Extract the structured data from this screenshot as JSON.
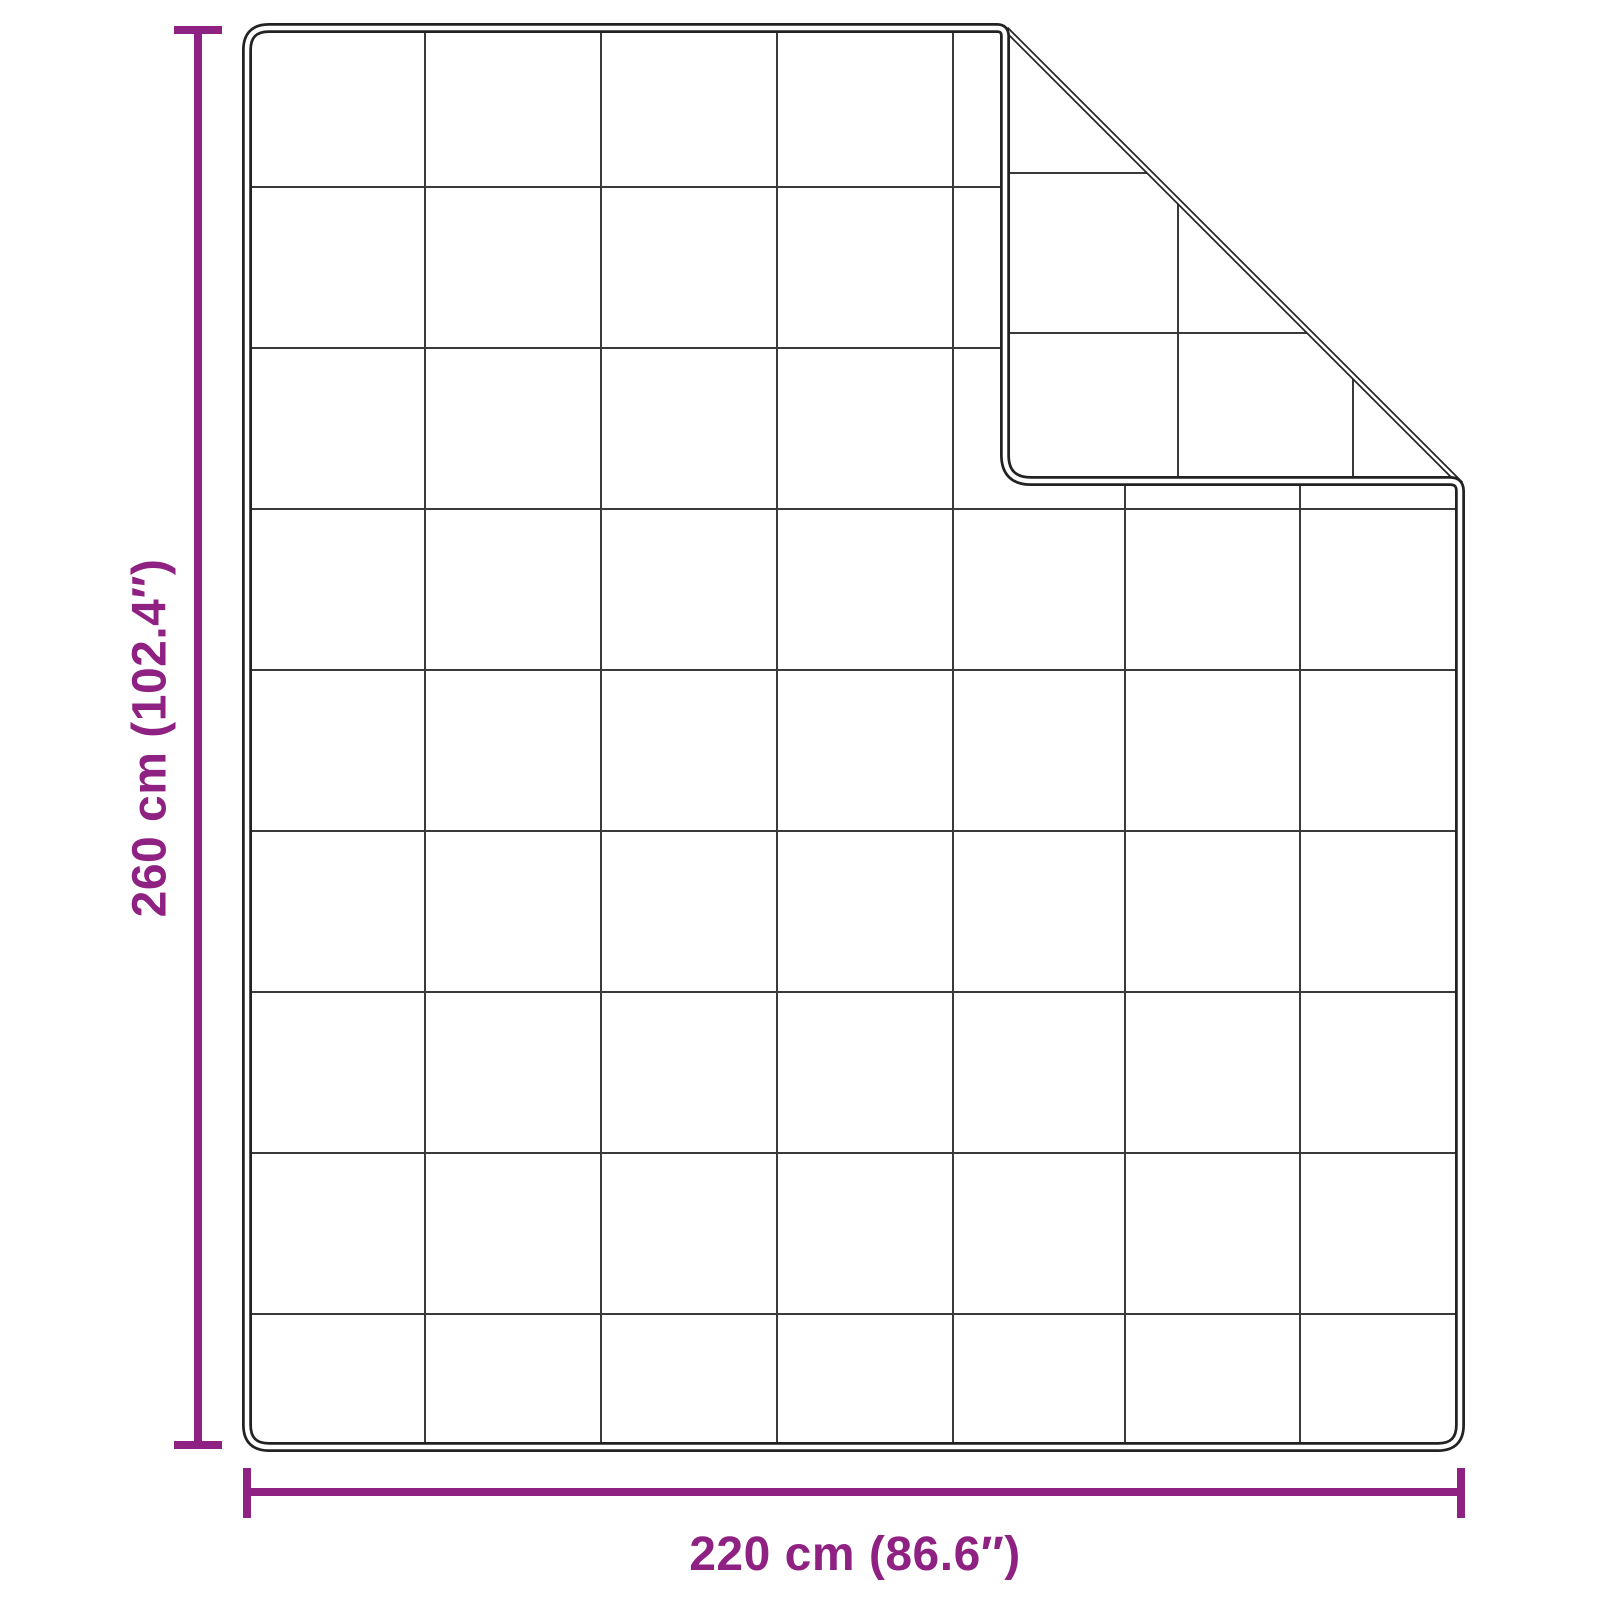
{
  "diagram": {
    "type": "product-dimension-diagram",
    "subject": "weighted blanket top view with folded top-right corner",
    "vertical_dimension": {
      "label": "260 cm (102.4″)"
    },
    "horizontal_dimension": {
      "label": "220 cm (86.6″)"
    },
    "grid": {
      "columns": 7,
      "rows": 9
    },
    "colors": {
      "accent": "#8e2181",
      "outline": "#222222",
      "grid_line": "#3a3a3a",
      "background": "#ffffff"
    }
  }
}
